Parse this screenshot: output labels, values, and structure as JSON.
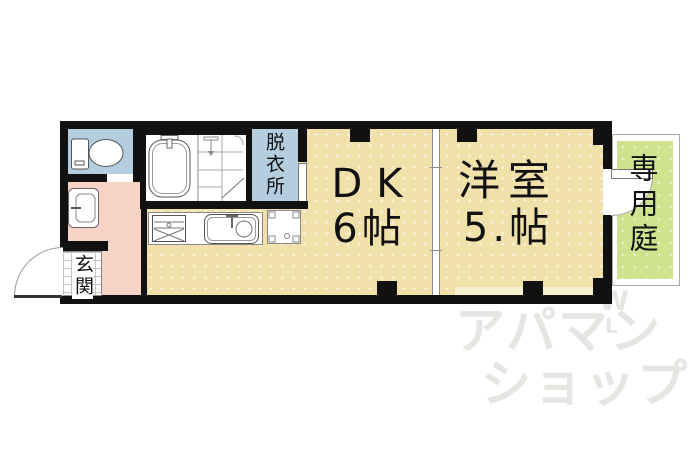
{
  "plan": {
    "rooms": {
      "dressing": {
        "label": "脱衣所"
      },
      "dining_kitchen": {
        "name": "DK",
        "size": "6帖"
      },
      "western_room": {
        "name": "洋室",
        "size": "5.帖"
      },
      "entrance": {
        "label": "玄関"
      },
      "private_garden": {
        "label": "専用庭"
      }
    },
    "colors": {
      "floor": "#f0e1aa",
      "floor_light": "#f7efcd",
      "wet_rooms": "#b4cedf",
      "hallway": "#f7d3c5",
      "garden": "#cfe28e",
      "wall": "#111111",
      "watermark": "#e6e5e1"
    }
  },
  "watermark": {
    "line1": "アパマン",
    "line2": "ショップ",
    "mark_top": "W",
    "mark_bottom": "L"
  }
}
